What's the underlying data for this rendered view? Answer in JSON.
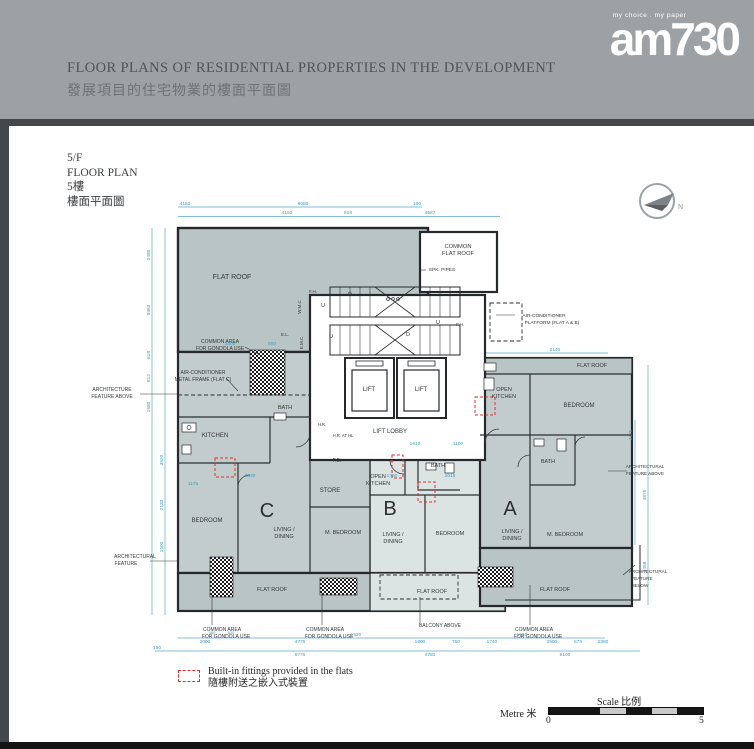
{
  "header": {
    "title_en": "FLOOR PLANS OF RESIDENTIAL PROPERTIES IN THE DEVELOPMENT",
    "title_zh": "發展項目的住宅物業的樓面平面圖",
    "logo_tagline": "my choice . my paper",
    "logo_text": "am730"
  },
  "floor_info": {
    "l1": "5/F",
    "l2": "FLOOR PLAN",
    "l3": "5樓",
    "l4": "樓面平面圖"
  },
  "compass": {
    "label": "N"
  },
  "legend": {
    "en": "Built-in fittings provided in the flats",
    "zh": "隨樓附送之嵌入式裝置"
  },
  "scale": {
    "title": "Scale 比例",
    "unit": "Metre 米",
    "zero": "0",
    "five": "5"
  },
  "colors": {
    "header_bg": "#9ba1a5",
    "bar_dark": "#43484b",
    "dim_cyan": "#3f9dc4",
    "fitting_red": "#e0312e",
    "roof_fill": "#b9c4c5",
    "flat_fill_light": "#dce3e3"
  },
  "plan": {
    "labels": [
      {
        "t": "FLAT ROOF",
        "x": 172,
        "y": 84,
        "s": 7
      },
      {
        "t": "COMMON",
        "x": 398,
        "y": 53,
        "s": 5.8
      },
      {
        "t": "FLAT ROOF",
        "x": 398,
        "y": 60,
        "s": 5.8
      },
      {
        "t": "SPK. PIPES",
        "x": 382,
        "y": 76,
        "s": 4.8
      },
      {
        "t": "AIR-CONDITIONER",
        "x": 484,
        "y": 122,
        "s": 4.8
      },
      {
        "t": "PLATFORM (FLAT A & B)",
        "x": 492,
        "y": 129,
        "s": 4.8
      },
      {
        "t": "COMMON AREA",
        "x": 160,
        "y": 148,
        "s": 5
      },
      {
        "t": "FOR GONDOLA USE",
        "x": 160,
        "y": 155,
        "s": 5
      },
      {
        "t": "AIR-CONDITIONER",
        "x": 143,
        "y": 179,
        "s": 5
      },
      {
        "t": "METAL FRAME (FLAT C)",
        "x": 143,
        "y": 186,
        "s": 5
      },
      {
        "t": "ARCHITECTURE",
        "x": 52,
        "y": 196,
        "s": 5
      },
      {
        "t": "FEATURE ABOVE",
        "x": 52,
        "y": 203,
        "s": 5
      },
      {
        "t": "KITCHEN",
        "x": 155,
        "y": 242,
        "s": 6
      },
      {
        "t": "BATH",
        "x": 225,
        "y": 214,
        "s": 5.5
      },
      {
        "t": "H.R. AT HL",
        "x": 283,
        "y": 242,
        "s": 4.2
      },
      {
        "t": "LIFT LOBBY",
        "x": 330,
        "y": 238,
        "s": 6
      },
      {
        "t": "LIFT",
        "x": 309,
        "y": 196,
        "s": 6
      },
      {
        "t": "LIFT",
        "x": 361,
        "y": 196,
        "s": 6
      },
      {
        "t": "P.D.",
        "x": 277,
        "y": 267,
        "s": 5
      },
      {
        "t": "OPEN",
        "x": 318,
        "y": 283,
        "s": 5.5
      },
      {
        "t": "KITCHEN",
        "x": 318,
        "y": 290,
        "s": 5.5
      },
      {
        "t": "OPEN",
        "x": 444,
        "y": 196,
        "s": 5.5
      },
      {
        "t": "KITCHEN",
        "x": 444,
        "y": 203,
        "s": 5.5
      },
      {
        "t": "STORE",
        "x": 270,
        "y": 297,
        "s": 6
      },
      {
        "t": "BEDROOM",
        "x": 147,
        "y": 327,
        "s": 6
      },
      {
        "t": "C",
        "x": 207,
        "y": 322,
        "s": 20,
        "cls": "big"
      },
      {
        "t": "LIVING /",
        "x": 224,
        "y": 336,
        "s": 5.5
      },
      {
        "t": "DINING",
        "x": 224,
        "y": 343,
        "s": 5.5
      },
      {
        "t": "M. BEDROOM",
        "x": 283,
        "y": 339,
        "s": 5.5
      },
      {
        "t": "B",
        "x": 330,
        "y": 320,
        "s": 20,
        "cls": "big"
      },
      {
        "t": "LIVING /",
        "x": 333,
        "y": 341,
        "s": 5.5
      },
      {
        "t": "DINING",
        "x": 333,
        "y": 348,
        "s": 5.5
      },
      {
        "t": "BEDROOM",
        "x": 390,
        "y": 340,
        "s": 5.5
      },
      {
        "t": "BATH",
        "x": 378,
        "y": 272,
        "s": 5.5
      },
      {
        "t": "BATH",
        "x": 488,
        "y": 268,
        "s": 5.5
      },
      {
        "t": "BEDROOM",
        "x": 519,
        "y": 212,
        "s": 6
      },
      {
        "t": "A",
        "x": 450,
        "y": 320,
        "s": 20,
        "cls": "big"
      },
      {
        "t": "LIVING /",
        "x": 452,
        "y": 338,
        "s": 5.5
      },
      {
        "t": "DINING",
        "x": 452,
        "y": 345,
        "s": 5.5
      },
      {
        "t": "M. BEDROOM",
        "x": 505,
        "y": 341,
        "s": 5.5
      },
      {
        "t": "FLAT ROOF",
        "x": 532,
        "y": 172,
        "s": 5.5
      },
      {
        "t": "FLAT ROOF",
        "x": 212,
        "y": 396,
        "s": 5.5
      },
      {
        "t": "FLAT ROOF",
        "x": 372,
        "y": 398,
        "s": 5.5
      },
      {
        "t": "FLAT ROOF",
        "x": 495,
        "y": 396,
        "s": 5.5
      },
      {
        "t": "ARCHITECTURAL",
        "x": 585,
        "y": 273,
        "s": 4.6
      },
      {
        "t": "FEATURE ABOVE",
        "x": 585,
        "y": 280,
        "s": 4.6
      },
      {
        "t": "ARCHITECTURAL",
        "x": 588,
        "y": 378,
        "s": 4.6
      },
      {
        "t": "FEATURE",
        "x": 582,
        "y": 385,
        "s": 4.6
      },
      {
        "t": "BELOW",
        "x": 580,
        "y": 392,
        "s": 4.6
      },
      {
        "t": "ARCHITECTURAL",
        "x": 75,
        "y": 363,
        "s": 5
      },
      {
        "t": "FEATURE",
        "x": 66,
        "y": 370,
        "s": 5
      },
      {
        "t": "COMMON AREA",
        "x": 162,
        "y": 436,
        "s": 5
      },
      {
        "t": "FOR GONDOLA USE",
        "x": 166,
        "y": 443,
        "s": 5
      },
      {
        "t": "COMMON AREA",
        "x": 265,
        "y": 436,
        "s": 5
      },
      {
        "t": "FOR GONDOLA USE",
        "x": 269,
        "y": 443,
        "s": 5
      },
      {
        "t": "COMMON AREA",
        "x": 474,
        "y": 436,
        "s": 5
      },
      {
        "t": "FOR GONDOLA USE",
        "x": 478,
        "y": 443,
        "s": 5
      },
      {
        "t": "BALCONY ABOVE",
        "x": 380,
        "y": 432,
        "s": 5
      },
      {
        "t": "W.M.C",
        "x": 241,
        "y": 112,
        "s": 4.5,
        "r": -90
      },
      {
        "t": "E.M.C",
        "x": 243,
        "y": 148,
        "s": 4.5,
        "r": -90
      },
      {
        "t": "E.L.",
        "x": 225,
        "y": 141,
        "s": 4.5
      },
      {
        "t": "F.H.",
        "x": 253,
        "y": 98,
        "s": 4.5
      },
      {
        "t": "F.H.",
        "x": 400,
        "y": 131,
        "s": 4.5
      },
      {
        "t": "H.R.",
        "x": 262,
        "y": 231,
        "s": 4.2
      },
      {
        "t": "U",
        "x": 263,
        "y": 112,
        "s": 5.5
      },
      {
        "t": "D",
        "x": 290,
        "y": 101,
        "s": 5.5
      },
      {
        "t": "U",
        "x": 271,
        "y": 143,
        "s": 5.5
      },
      {
        "t": "D",
        "x": 348,
        "y": 141,
        "s": 5.5
      },
      {
        "t": "U",
        "x": 378,
        "y": 129,
        "s": 5.5
      }
    ],
    "dims": [
      {
        "t": "4150",
        "x": 125,
        "y": 10
      },
      {
        "t": "8080",
        "x": 243,
        "y": 10
      },
      {
        "t": "100",
        "x": 357,
        "y": 10
      },
      {
        "t": "4150",
        "x": 227,
        "y": 19
      },
      {
        "t": "818",
        "x": 288,
        "y": 19
      },
      {
        "t": "4587",
        "x": 370,
        "y": 19
      },
      {
        "t": "2485",
        "x": 90,
        "y": 60,
        "r": -90
      },
      {
        "t": "5963",
        "x": 90,
        "y": 115,
        "r": -90
      },
      {
        "t": "618",
        "x": 90,
        "y": 160,
        "r": -90
      },
      {
        "t": "812",
        "x": 90,
        "y": 183,
        "r": -90
      },
      {
        "t": "1580",
        "x": 90,
        "y": 212,
        "r": -90
      },
      {
        "t": "3520",
        "x": 103,
        "y": 265,
        "r": -90
      },
      {
        "t": "2130",
        "x": 103,
        "y": 310,
        "r": -90
      },
      {
        "t": "1500",
        "x": 103,
        "y": 352,
        "r": -90
      },
      {
        "t": "3305",
        "x": 170,
        "y": 150
      },
      {
        "t": "860",
        "x": 212,
        "y": 150
      },
      {
        "t": "2140",
        "x": 495,
        "y": 156
      },
      {
        "t": "1175",
        "x": 133,
        "y": 290
      },
      {
        "t": "2330",
        "x": 190,
        "y": 282
      },
      {
        "t": "1750",
        "x": 332,
        "y": 282
      },
      {
        "t": "2015",
        "x": 390,
        "y": 282
      },
      {
        "t": "1610",
        "x": 355,
        "y": 250
      },
      {
        "t": "1100",
        "x": 398,
        "y": 250
      },
      {
        "t": "3475",
        "x": 572,
        "y": 240,
        "r": -90
      },
      {
        "t": "4875",
        "x": 586,
        "y": 300,
        "r": -90
      },
      {
        "t": "1458",
        "x": 586,
        "y": 372,
        "r": -90
      },
      {
        "t": "460",
        "x": 152,
        "y": 439,
        "s": 4
      },
      {
        "t": "820",
        "x": 171,
        "y": 439,
        "s": 4
      },
      {
        "t": "2000",
        "x": 145,
        "y": 448
      },
      {
        "t": "4775",
        "x": 240,
        "y": 448
      },
      {
        "t": "1520",
        "x": 296,
        "y": 441
      },
      {
        "t": "1800",
        "x": 360,
        "y": 448
      },
      {
        "t": "750",
        "x": 396,
        "y": 448
      },
      {
        "t": "1740",
        "x": 432,
        "y": 448
      },
      {
        "t": "1520",
        "x": 462,
        "y": 441
      },
      {
        "t": "2500",
        "x": 492,
        "y": 448
      },
      {
        "t": "675",
        "x": 518,
        "y": 448
      },
      {
        "t": "2380",
        "x": 543,
        "y": 448
      },
      {
        "t": "150",
        "x": 97,
        "y": 454
      },
      {
        "t": "6775",
        "x": 240,
        "y": 461
      },
      {
        "t": "4780",
        "x": 370,
        "y": 461
      },
      {
        "t": "6100",
        "x": 505,
        "y": 461
      }
    ]
  }
}
